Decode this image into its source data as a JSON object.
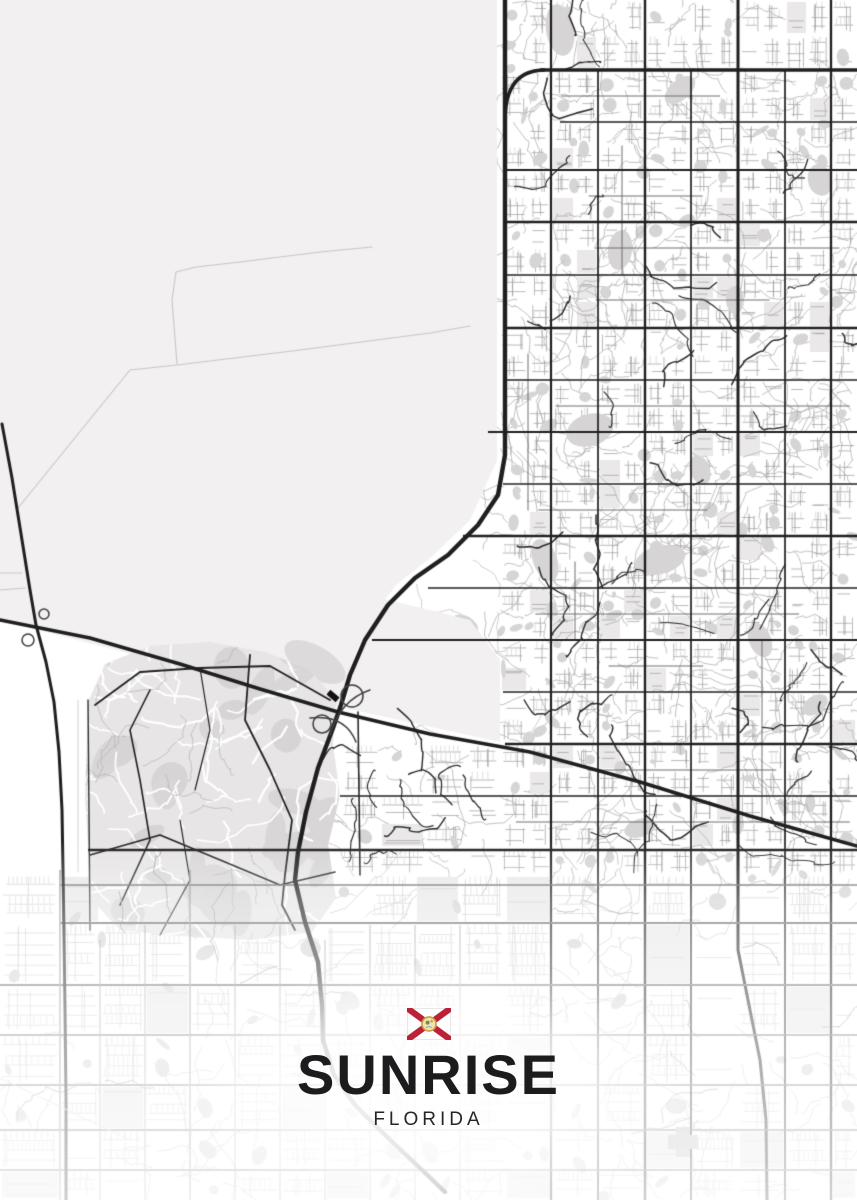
{
  "poster": {
    "title": "SUNRISE",
    "subtitle": "FLORIDA",
    "colors": {
      "title_text": "#1c1c1e",
      "subtitle_text": "#26262a",
      "flag_white": "#ffffff",
      "flag_border": "#e3e1e2",
      "flag_red": "#bd2138",
      "seal_gold": "#cfa03c",
      "seal_paper": "#efe2b8",
      "seal_green": "#6e8f52",
      "seal_blue": "#7fa3bd"
    }
  },
  "map": {
    "city": "Sunrise",
    "state": "Florida",
    "style": "monochrome street-map poster, open land northwest, dense grid east, curvy suburbs southwest, faded south edge",
    "colors": {
      "background": "#ffffff",
      "open_land": "#f2f0f1",
      "trail": "#c8c6c7",
      "minor_road": "#9d9d9d",
      "fine_road": "#c6c6c6",
      "collector_road": "#6e6e6e",
      "dark_local": "#2e2e2e",
      "major_road": "#1f1f1f",
      "water_park": "#d6d4d5",
      "block_tint": "#eae8e9",
      "organic_fill": "#d8d6d7",
      "building": "#c3c1c2",
      "fade_white": "#ffffff"
    }
  }
}
